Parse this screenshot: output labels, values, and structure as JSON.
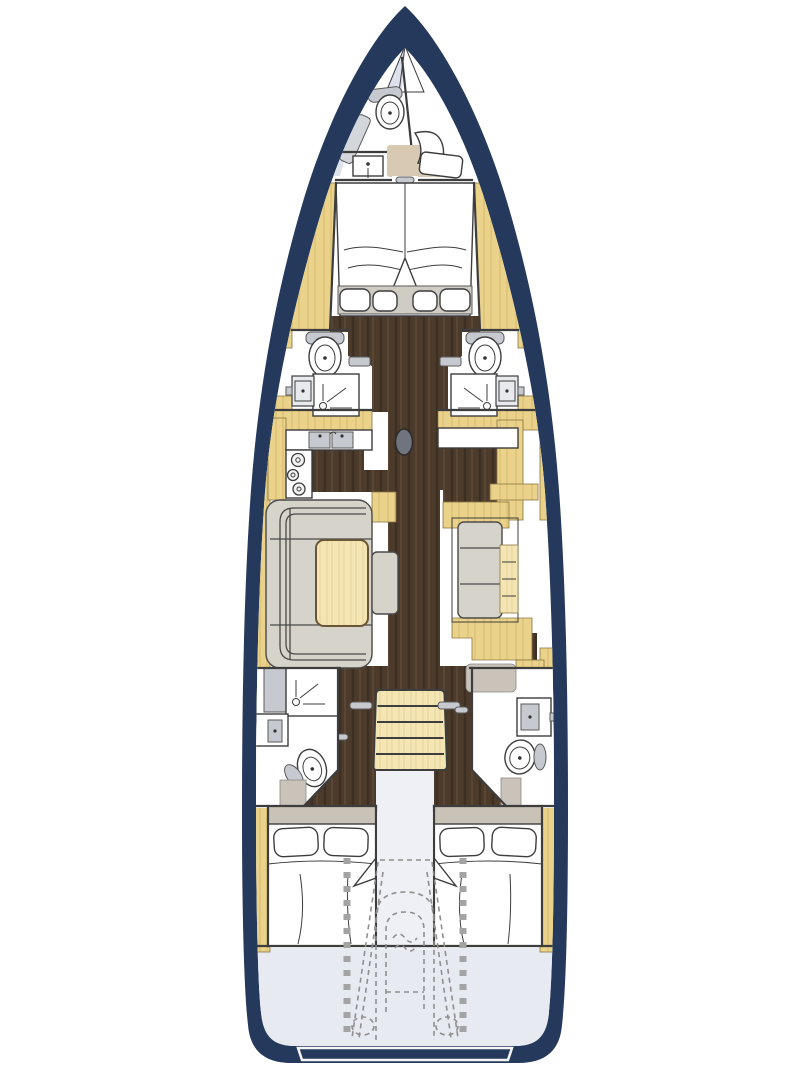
{
  "title": "Sailing yacht interior deck plan (top view floor plan)",
  "colors": {
    "background": "#ffffff",
    "hull": "#25395c",
    "interior": "#ffffff",
    "teak": "#ead28b",
    "teakGrain": "#c9ad5f",
    "lightWood": "#f4e6b4",
    "lightWoodGrain": "#dfc987",
    "walnut": "#4c3b2b",
    "walnutStreak": "#3a2c1f",
    "walnutLight": "#5f4b37",
    "cockpitFloor": "#e8eaf1",
    "anchorLocker": "#dde1ec",
    "sofa": "#d6d3ca",
    "sofaSeam": "#4a4a4a",
    "carpetTan": "#d7c9b2",
    "carpetGray": "#c9c3ba",
    "fixture": "#c6c9cf",
    "outline": "#3d3d3d",
    "dash": "#8f8f8f",
    "mast": "#70747c",
    "platformOutline": "#f5f5f7"
  },
  "legend": {
    "fixtures": [
      "anchor-locker",
      "toilet",
      "washbasin",
      "shower",
      "bench",
      "v-berth-bed",
      "pillow",
      "wardrobe",
      "galley-sink",
      "stove",
      "counter",
      "mast",
      "sofa",
      "saloon-table",
      "ottoman",
      "settee",
      "sideboard",
      "companionway-stairs",
      "door-handle",
      "double-bed",
      "engine-and-steering-dashed",
      "swim-platform"
    ]
  }
}
